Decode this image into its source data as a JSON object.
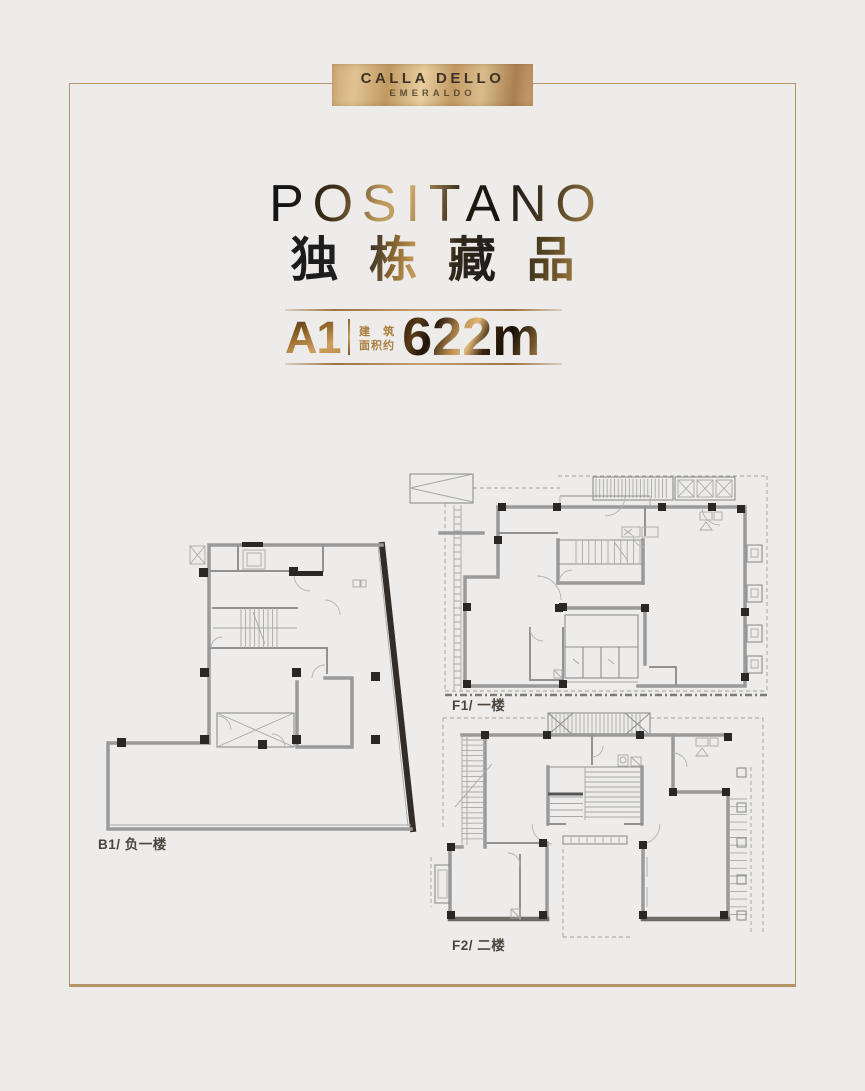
{
  "colors": {
    "background": "#edecea",
    "frame_gold": "#b6946a",
    "accent_gold": "#ac7e3e",
    "label_dark": "#4b453e"
  },
  "logo": {
    "line1": "CALLA DELLO",
    "line2": "EMERALDO"
  },
  "hero": {
    "title": "POSITANO",
    "subtitle": "独栋藏品"
  },
  "spec": {
    "unit": "A1",
    "area_label_line1": "建 筑",
    "area_label_line2": "面积约",
    "area_value": "622",
    "area_unit": "m",
    "area_exponent": "2"
  },
  "floorplans": [
    {
      "id": "b1",
      "label": "B1/ 负一楼"
    },
    {
      "id": "f1",
      "label": "F1/ 一楼"
    },
    {
      "id": "f2",
      "label": "F2/ 二楼"
    }
  ]
}
